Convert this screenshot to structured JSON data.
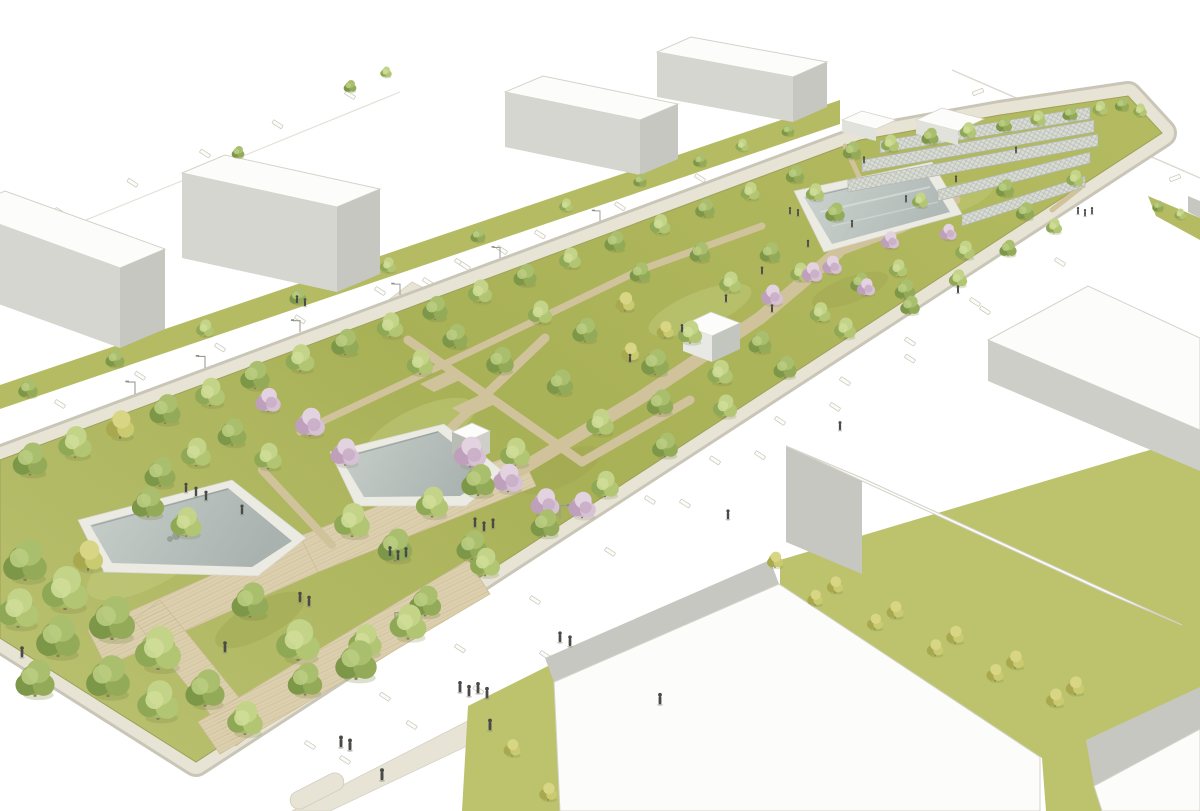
{
  "scene": {
    "type": "architectural-rendering",
    "description": "Aerial rendering of a linear park masterplan: a long landscaped strip with tree groves, cherry blossoms, diagonal gravel paths, a timber boardwalk, angular sunken reflecting pools, hatched garden court strips and small white cube pavilions, flanked by white streets with parallel parking bays, street lamps, pedestrians and rows of plain white box buildings.",
    "labels": {
      "park": "Linear park",
      "pools": "Reflecting pools",
      "boardwalk": "Timber boardwalk",
      "courts": "Garden court strips",
      "pavilions": "White cube pavilions",
      "buildings_north": "North row of block buildings",
      "buildings_south": "South row of block buildings",
      "streets": "Streets with parking bays",
      "pedestrians": "Pedestrians",
      "lamps": "Street lamps"
    }
  },
  "palette": {
    "background": "#ffffff",
    "roof": "#fcfcfa",
    "bld-edge": "#d4d2c8",
    "bld-face": "#d6d6d0",
    "bld-face-mid": "#cecec8",
    "bld-face-dark": "#c7c7c1",
    "grass": "#aeb65c",
    "grass-light": "#c6cf82",
    "verge": "#b4bb62",
    "lawn": "#bcc36c",
    "sidewalk": "#e8e4d5",
    "sidewalk-edge": "#c9c6b8",
    "path": "#d0c39c",
    "wood": "#dccfad",
    "water": "#aab3b0",
    "water-light": "#cad1cd",
    "pool-rim": "#ebebe3",
    "court": "#dadcd4",
    "court-line": "#aeb4ac",
    "road-line": "#dcd9cd",
    "tree-green": "#8fa751",
    "tree-light": "#a4ba67",
    "blossom": "#cdb3ca",
    "tree-yellow": "#bcbc5e",
    "figure": "#4a4a46"
  }
}
